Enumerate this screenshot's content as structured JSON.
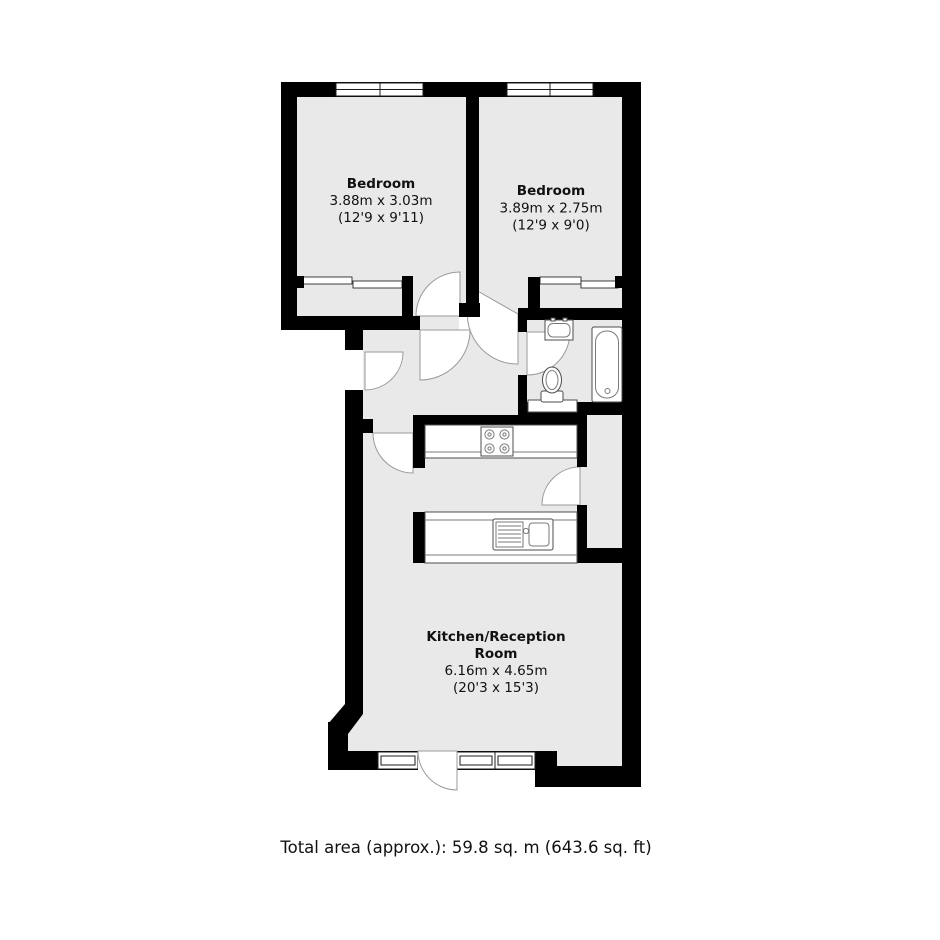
{
  "plan": {
    "type": "residential-floor-plan",
    "rooms": [
      {
        "name": "Bedroom",
        "dims_m": "3.88m x 3.03m",
        "dims_ft": "(12'9 x 9'11)"
      },
      {
        "name": "Bedroom",
        "dims_m": "3.89m x 2.75m",
        "dims_ft": "(12'9 x 9'0)"
      },
      {
        "name_line1": "Kitchen/Reception",
        "name_line2": "Room",
        "dims_m": "6.16m x 4.65m",
        "dims_ft": "(20'3 x 15'3)"
      }
    ],
    "fixtures": [
      "window",
      "door-swing",
      "wardrobe",
      "bathtub",
      "toilet",
      "washbasin",
      "hob",
      "kitchen-sink",
      "worktop"
    ],
    "colors": {
      "wall": "#000000",
      "floor": "#e9e9e9",
      "background": "#ffffff",
      "door_arc": "#9a9a9a",
      "text": "#111111"
    }
  },
  "footer": {
    "total_area": "Total area (approx.): 59.8 sq. m (643.6 sq. ft)"
  }
}
